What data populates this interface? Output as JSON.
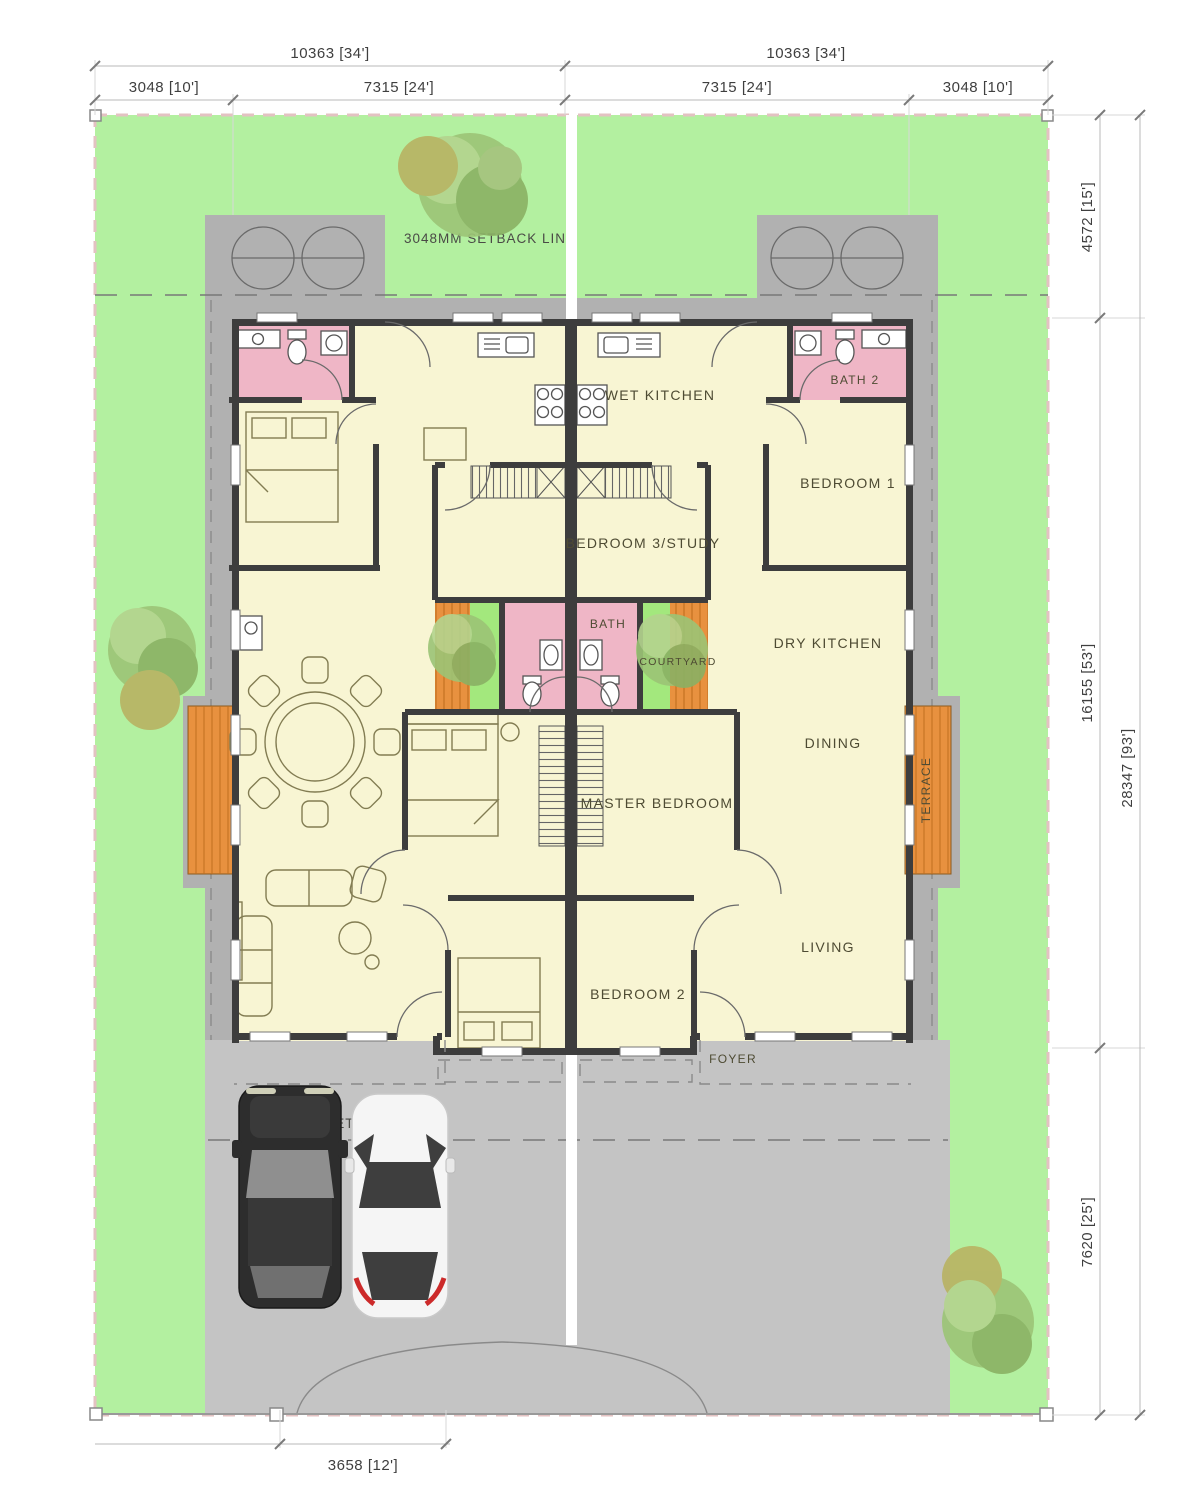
{
  "rooms": {
    "wet_kitchen": "WET KITCHEN",
    "bath2": "BATH 2",
    "bedroom1": "BEDROOM 1",
    "bedroom3_study": "BEDROOM 3/STUDY",
    "dry_kitchen": "DRY KITCHEN",
    "bath": "BATH",
    "courtyard": "COURTYARD",
    "dining": "DINING",
    "master_bedroom": "MASTER BEDROOM",
    "terrace": "TERRACE",
    "living": "LIVING",
    "bedroom2": "BEDROOM 2",
    "foyer": "FOYER"
  },
  "setbacks": {
    "front": "3048MM SETBACK LINE",
    "rear": "6069MM SETBACK LINE"
  },
  "dims": {
    "overall_left": "10363 [34']",
    "overall_right": "10363 [34']",
    "side_left": "3048 [10']",
    "unit_left": "7315 [24']",
    "unit_right": "7315 [24']",
    "side_right": "3048 [10']",
    "front_yard": "4572 [15']",
    "house_depth": "16155 [53']",
    "lot_depth": "28347 [93']",
    "rear_yard": "7620 [25']",
    "gate_width": "3658 [12']"
  },
  "colors": {
    "lawn": "#b3f0a0",
    "courtyard_green": "#a3e87d",
    "apron": "#b1b1b1",
    "driveway": "#c4c4c4",
    "room": "#f8f5d3",
    "bath_pink": "#efb6c6",
    "deck": "#e8913f",
    "wall": "#3d3d3d"
  }
}
